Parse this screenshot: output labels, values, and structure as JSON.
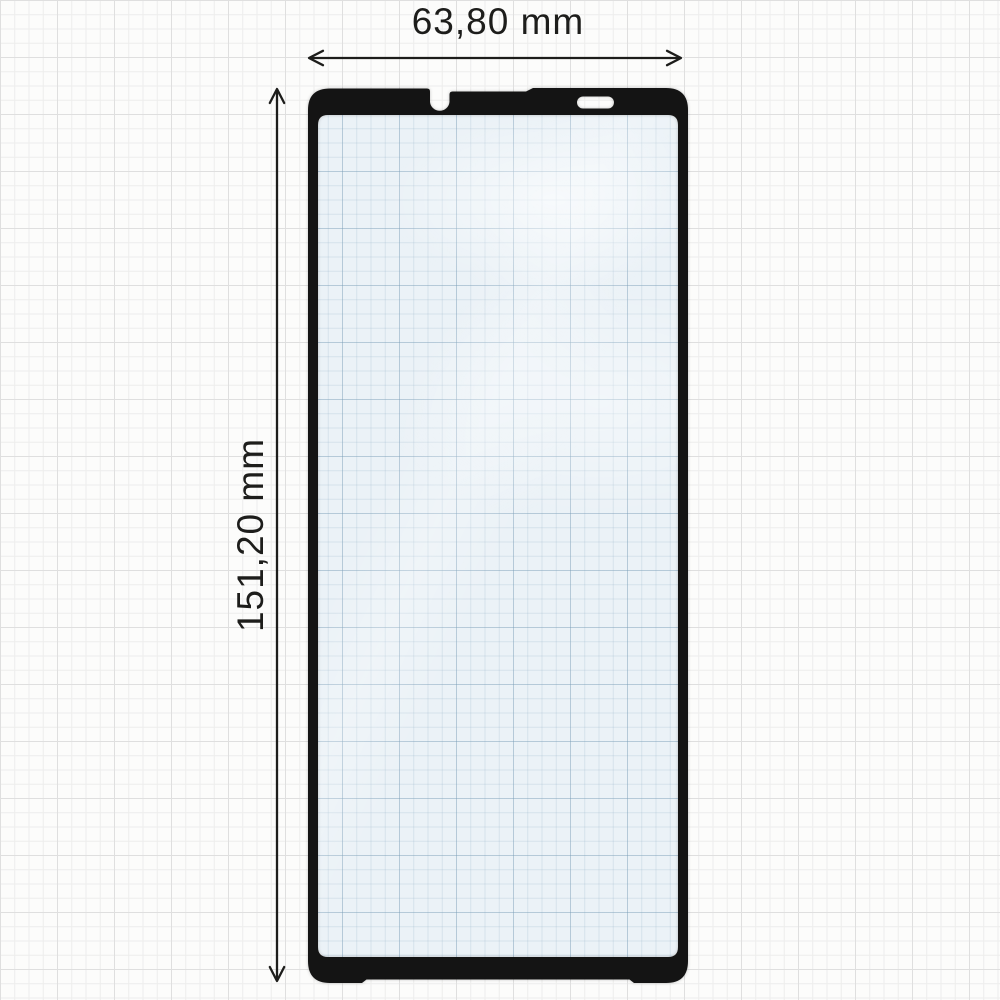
{
  "diagram": {
    "type": "product-dimension-diagram",
    "subject": "tempered-glass-screen-protector",
    "background": "graph-paper"
  },
  "labels": {
    "width": "63,80 mm",
    "height": "151,20 mm"
  },
  "features": {
    "camera_notch": "u-notch-top-center-left",
    "speaker_cutout": "pill-top-right"
  },
  "colors": {
    "paper": "#fcfcfb",
    "grid_minor": "#ededec",
    "grid_major": "#dfdfdf",
    "frame": "#141414",
    "screen_tint": "#ebf2f7",
    "cutout": "#fdfdfc",
    "dimension_lines": "#1d1d1b"
  }
}
